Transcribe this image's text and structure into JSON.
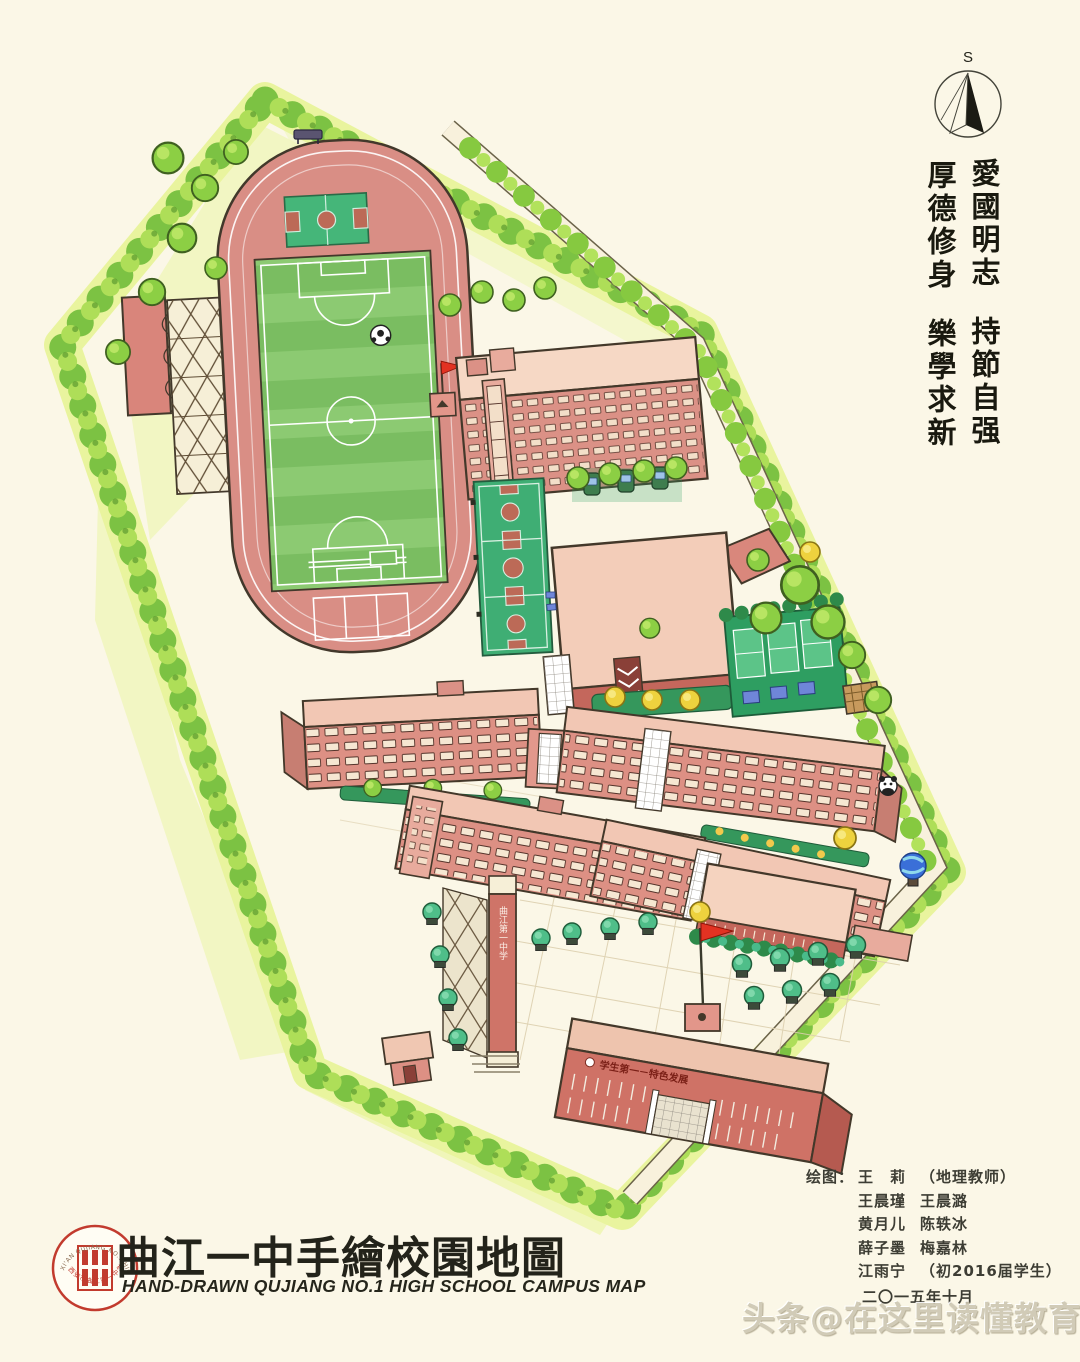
{
  "canvas": {
    "background": "#fbf7e7"
  },
  "compass": {
    "label": "S"
  },
  "motto": {
    "right_top": "愛國明志",
    "right_bottom": "持節自强",
    "left_top": "厚德修身",
    "left_bottom": "樂學求新"
  },
  "map_labels": {
    "gate_tower": "曲江第一中学",
    "gate_banner": "学生第一－特色发展"
  },
  "title_block": {
    "title": "曲江一中手繪校園地圖",
    "subtitle": "HAND-DRAWN QUJIANG NO.1 HIGH SCHOOL CAMPUS MAP",
    "logo_ring_top": "XI'AN QUJIANG NO.1 HIGH SCHOOL",
    "logo_ring_bottom": "西安市曲江第一中学"
  },
  "credits": {
    "label": "绘图：",
    "rows": [
      {
        "left": "王　莉",
        "right": "（地理教师）"
      },
      {
        "left": "王晨瑾",
        "right": "王晨潞"
      },
      {
        "left": "黄月儿",
        "right": "陈轶冰"
      },
      {
        "left": "薛子墨",
        "right": "梅嘉林"
      },
      {
        "left": "江雨宁",
        "right": "（初2016届学生）"
      }
    ],
    "date": "二〇一五年十月"
  },
  "watermark": "头条@在这里读懂教育",
  "colors": {
    "track_pink": "#d98e85",
    "field_green": "#83c468",
    "court_green": "#3fae74",
    "building_wall": "#dd9084",
    "building_roof": "#f3cdb9",
    "tree_green": "#8ccf44",
    "tree_teal": "#4fbe89",
    "tree_yellow": "#eed23e",
    "flag_red": "#e23222",
    "boundary_band": "#e9f49e"
  }
}
